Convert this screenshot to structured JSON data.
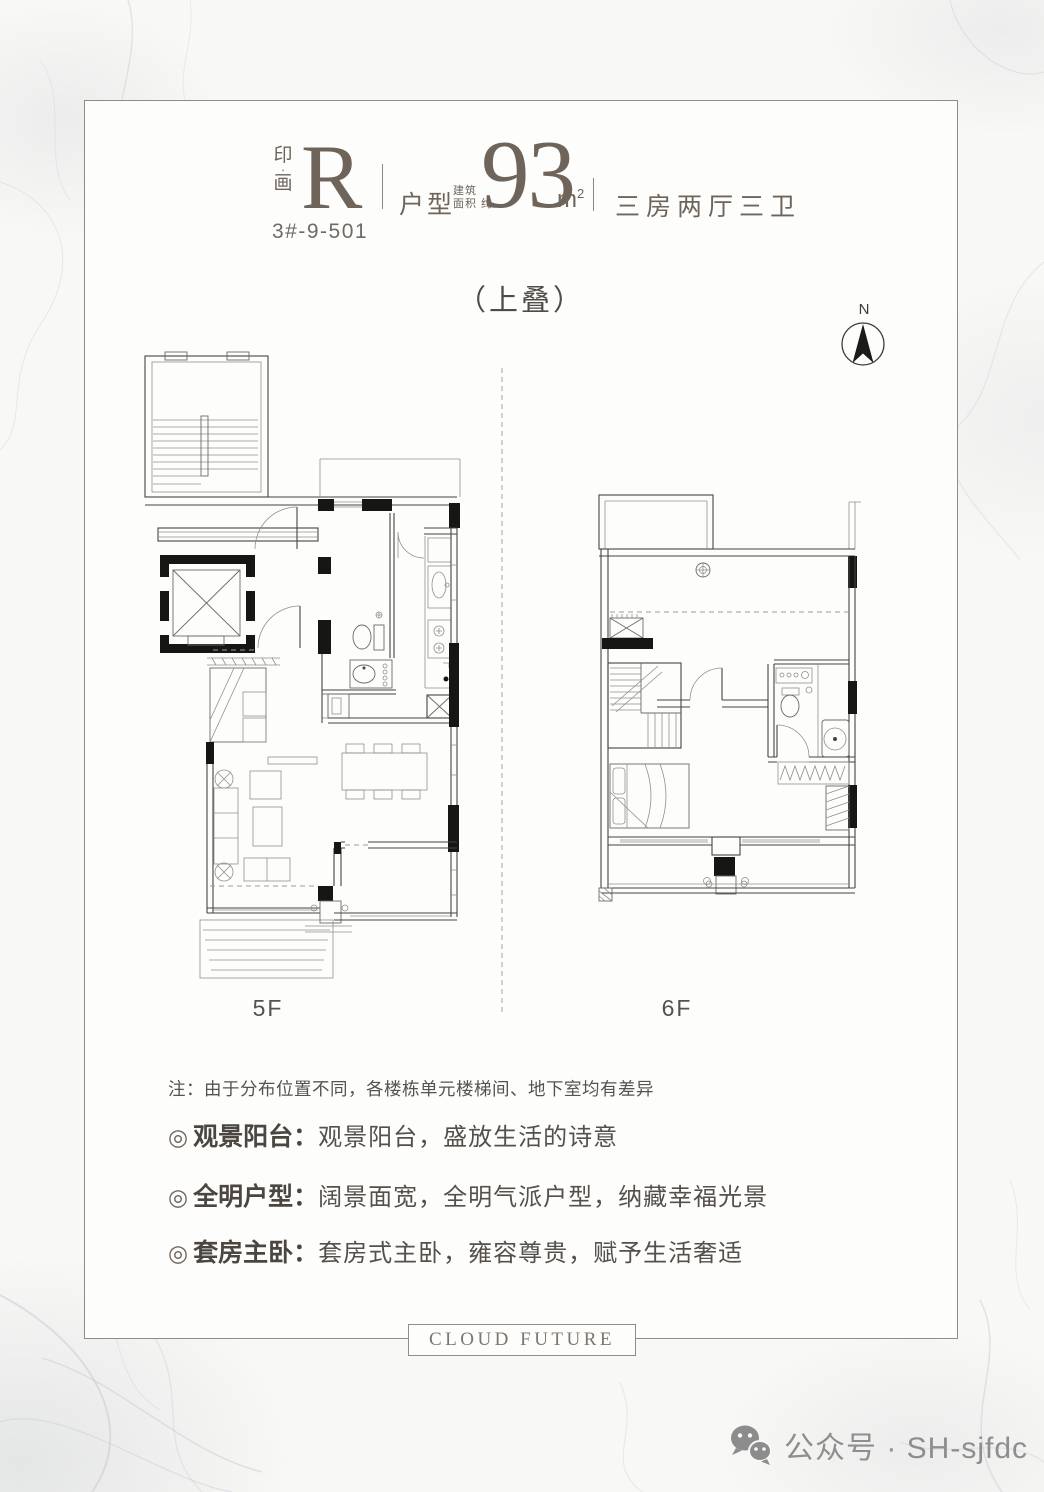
{
  "header": {
    "brand_top": "印",
    "brand_dot": "·",
    "brand_bottom": "画",
    "unit_letter": "R",
    "type_label": "户型",
    "area_note_line1": "建筑",
    "area_note_line2": "面积 约",
    "area_value": "93",
    "area_unit": "m",
    "area_unit_sup": "2",
    "rooms_text": "三房两厅三卫",
    "unit_code": "3#-9-501"
  },
  "subtitle": "（上叠）",
  "compass_label": "N",
  "floors": [
    {
      "label": "5F"
    },
    {
      "label": "6F"
    }
  ],
  "note": "注：由于分布位置不同，各楼栋单元楼梯间、地下室均有差异",
  "features": [
    {
      "marker": "◎",
      "title": "观景阳台：",
      "desc": "观景阳台，盛放生活的诗意"
    },
    {
      "marker": "◎",
      "title": "全明户型：",
      "desc": "阔景面宽，全明气派户型，纳藏幸福光景"
    },
    {
      "marker": "◎",
      "title": "套房主卧：",
      "desc": "套房式主卧，雍容尊贵，赋予生活奢适"
    }
  ],
  "footer": {
    "brand_box_text": "CLOUD FUTURE",
    "wechat_text": "公众号 · SH-sjfdc"
  },
  "colors": {
    "accent": "#6e6459",
    "frame_line": "#8d8d84",
    "plan_line": "#44443f"
  }
}
